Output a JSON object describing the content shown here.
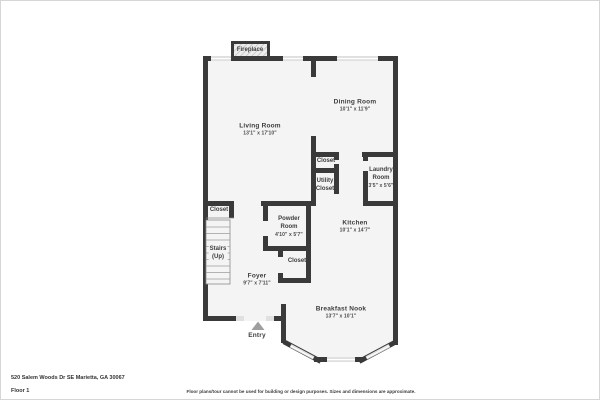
{
  "colors": {
    "wall": "#3a3a3a",
    "floor": "#f4f4f4",
    "window": "#e0e0e0",
    "entry_arrow": "#9e9e9e"
  },
  "rooms": {
    "living": {
      "name": "Living Room",
      "dims": "13'1\" x 17'10\""
    },
    "dining": {
      "name": "Dining Room",
      "dims": "10'1\" x 11'9\""
    },
    "kitchen": {
      "name": "Kitchen",
      "dims": "10'1\" x 14'7\""
    },
    "laundry": {
      "line1": "Laundry",
      "line2": "Room",
      "dims": "3'5\" x 5'6\""
    },
    "powder": {
      "line1": "Powder",
      "line2": "Room",
      "dims": "4'10\" x 5'7\""
    },
    "foyer": {
      "name": "Foyer",
      "dims": "9'7\" x 7'11\""
    },
    "breakfast_nook": {
      "name": "Breakfast Nook",
      "dims": "13'7\" x 10'1\""
    },
    "stairs": {
      "line1": "Stairs",
      "line2": "(Up)"
    },
    "closet_entry": {
      "name": "Closet"
    },
    "closet_hall": {
      "name": "Closet"
    },
    "utility_closet": {
      "line1": "Utility",
      "line2": "Closet"
    },
    "closet_foyer": {
      "name": "Closet"
    }
  },
  "features": {
    "fireplace": "Fireplace",
    "entry": "Entry"
  },
  "footer": {
    "address": "520 Salem Woods Dr SE Marietta, GA 30067",
    "floor_label": "Floor 1",
    "disclaimer": "Floor plans/tour cannot be used for building or design purposes. Sizes and dimensions are approximate."
  }
}
